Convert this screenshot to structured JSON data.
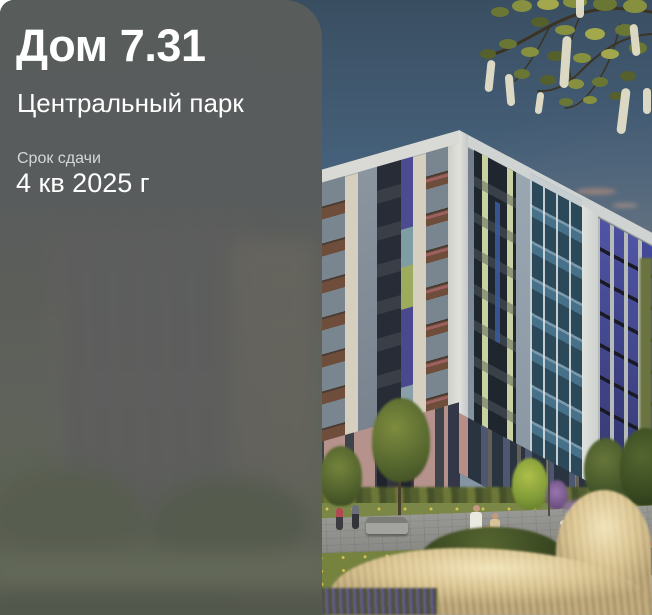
{
  "panel": {
    "title": "Дом 7.31",
    "subtitle": "Центральный парк",
    "deadline": {
      "label": "Срок сдачи",
      "value": "4 кв 2025 г"
    }
  },
  "colors": {
    "panel_tint": "#55595a",
    "text_primary": "#ffffff",
    "text_secondary": "#d6d8d7",
    "sky_top": "#3a4e61",
    "sky_horizon": "#a3a49d",
    "facade_cream": "#d6cfc0",
    "facade_slate": "#7b8894",
    "facade_brown": "#6e4e3a",
    "facade_teal": "#477089",
    "facade_indigo": "#4a4d9c",
    "facade_pink": "#b5928b",
    "facade_navy_base": "#2a3340",
    "lawn_green": "#76833f",
    "grass_gold": "#dfcda0",
    "lavender": "#6f6298"
  }
}
